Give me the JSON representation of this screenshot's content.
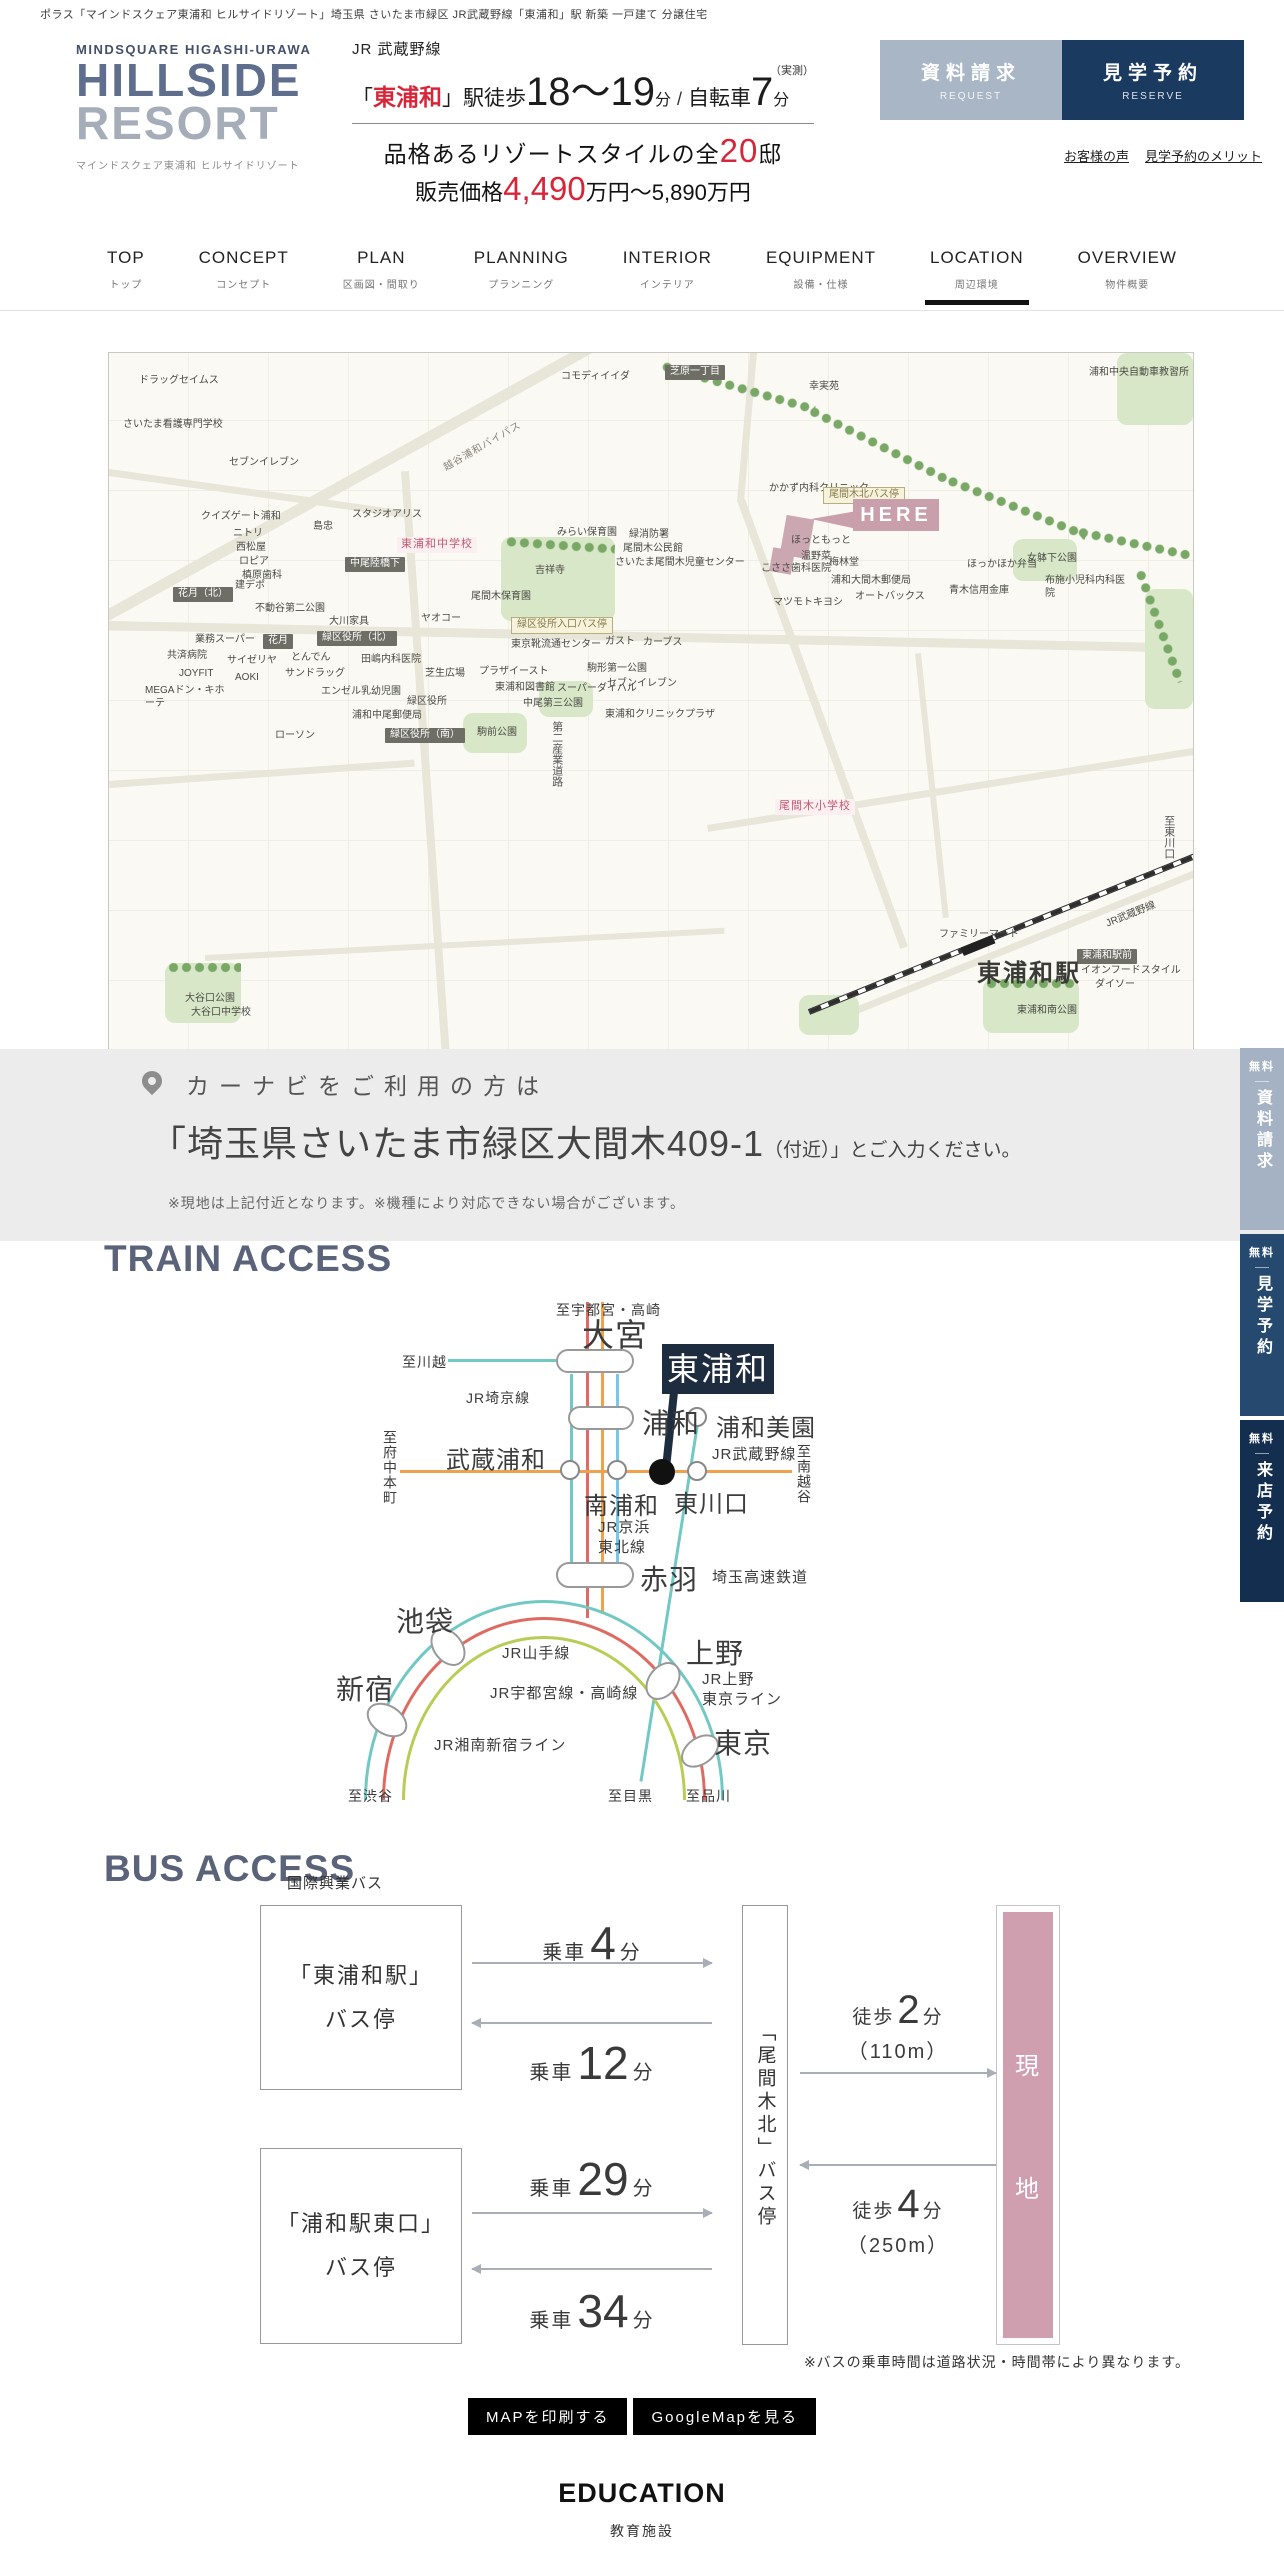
{
  "colors": {
    "accent": "#d7263a",
    "navy": "#1b3a60",
    "navy_dark": "#1e2c3f",
    "btnlight": "#a9b6c6",
    "heading": "#5a6379",
    "here": "#c99fab",
    "genchi": "#cf9fb0",
    "logo1": "#5f6e8c",
    "logo2": "#a4adb8",
    "line_teal": "#72c8c3",
    "line_red": "#df6a62",
    "line_orange": "#f0a14e",
    "line_sky": "#79c7e6",
    "line_green": "#b9cc55",
    "fb1": "#a4b2c3",
    "fb2": "#26496f",
    "fb3": "#142e50"
  },
  "topbar": {
    "text": "ポラス「マインドスクェア東浦和 ヒルサイドリゾート」埼玉県 さいたま市緑区 JR武蔵野線「東浦和」駅 新築 一戸建て 分譲住宅"
  },
  "header": {
    "brand_top": "MINDSQUARE HIGASHI-URAWA",
    "brand_main1": "HILLSIDE",
    "brand_main2": "RESORT",
    "brand_sub": "マインドスクェア東浦和 ヒルサイドリゾート",
    "line_name": "JR 武蔵野線",
    "open": "「",
    "station": "東浦和",
    "close": "」",
    "walk": "駅徒歩",
    "walk_min": "18〜19",
    "min_unit": "分",
    "slash": "/",
    "bike": "自転車",
    "bike_min": "7",
    "bike_unit": "分",
    "note": "（実測）",
    "copy_pre": "品格あるリゾートスタイルの全",
    "copy_num": "20",
    "copy_post": "邸",
    "price_pre": "販売価格",
    "price_num": "4,490",
    "price_post": "万円〜5,890万円",
    "btn_request": {
      "jp": "資料請求",
      "en": "REQUEST"
    },
    "btn_reserve": {
      "jp": "見学予約",
      "en": "RESERVE"
    },
    "link_voice": "お客様の声",
    "link_merit": "見学予約のメリット"
  },
  "nav": {
    "items": [
      {
        "en": "TOP",
        "jp": "トップ"
      },
      {
        "en": "CONCEPT",
        "jp": "コンセプト"
      },
      {
        "en": "PLAN",
        "jp": "区画図・間取り"
      },
      {
        "en": "PLANNING",
        "jp": "プランニング"
      },
      {
        "en": "INTERIOR",
        "jp": "インテリア"
      },
      {
        "en": "EQUIPMENT",
        "jp": "設備・仕様"
      },
      {
        "en": "LOCATION",
        "jp": "周辺環境",
        "active": true
      },
      {
        "en": "OVERVIEW",
        "jp": "物件概要"
      }
    ]
  },
  "map": {
    "here_label": "HERE",
    "labels": [
      {
        "t": "ドラッグセイムス",
        "x": 30,
        "y": 22
      },
      {
        "t": "さいたま看護専門学校",
        "x": 14,
        "y": 66
      },
      {
        "t": "セブンイレブン",
        "x": 120,
        "y": 104
      },
      {
        "t": "コモディイイダ",
        "x": 452,
        "y": 18
      },
      {
        "t": "幸実苑",
        "x": 700,
        "y": 28
      },
      {
        "t": "浦和中央自動車教習所",
        "x": 980,
        "y": 14,
        "w": 104
      },
      {
        "t": "越谷浦和バイパス",
        "x": 330,
        "y": 88,
        "k": "road",
        "rot": -30
      },
      {
        "t": "芝原一丁目",
        "x": 556,
        "y": 12,
        "k": "bd"
      },
      {
        "t": "クイズゲート浦和",
        "x": 92,
        "y": 158
      },
      {
        "t": "ニトリ",
        "x": 124,
        "y": 175
      },
      {
        "t": "西松屋",
        "x": 127,
        "y": 189
      },
      {
        "t": "ロピア",
        "x": 130,
        "y": 203
      },
      {
        "t": "槙原歯科",
        "x": 133,
        "y": 217
      },
      {
        "t": "島忠",
        "x": 204,
        "y": 168
      },
      {
        "t": "スタジオアリス",
        "x": 243,
        "y": 156
      },
      {
        "t": "東浦和中学校",
        "x": 288,
        "y": 184,
        "k": "bp"
      },
      {
        "t": "中尾陸橋下",
        "x": 236,
        "y": 204,
        "k": "bd"
      },
      {
        "t": "花月（北）",
        "x": 64,
        "y": 234,
        "k": "bd"
      },
      {
        "t": "建デポ",
        "x": 126,
        "y": 227
      },
      {
        "t": "不動谷第二公園",
        "x": 146,
        "y": 250
      },
      {
        "t": "大川家具",
        "x": 220,
        "y": 263
      },
      {
        "t": "みらい保育園",
        "x": 448,
        "y": 174
      },
      {
        "t": "緑消防署",
        "x": 520,
        "y": 176
      },
      {
        "t": "尾間木公民館",
        "x": 514,
        "y": 190
      },
      {
        "t": "さいたま尾間木児童センター",
        "x": 506,
        "y": 204
      },
      {
        "t": "吉祥寺",
        "x": 426,
        "y": 212
      },
      {
        "t": "尾間木保育園",
        "x": 362,
        "y": 238
      },
      {
        "t": "緑区役所入口バス停",
        "x": 402,
        "y": 264,
        "k": "bb"
      },
      {
        "t": "ヤオコー",
        "x": 312,
        "y": 260
      },
      {
        "t": "東京靴流通センター",
        "x": 402,
        "y": 286
      },
      {
        "t": "緑区役所（北）",
        "x": 208,
        "y": 278,
        "k": "bd"
      },
      {
        "t": "花月",
        "x": 154,
        "y": 281,
        "k": "bd"
      },
      {
        "t": "業務スーパー",
        "x": 86,
        "y": 281
      },
      {
        "t": "共済病院",
        "x": 58,
        "y": 297
      },
      {
        "t": "サイゼリヤ",
        "x": 118,
        "y": 302
      },
      {
        "t": "とんでん",
        "x": 182,
        "y": 299
      },
      {
        "t": "田嶋内科医院",
        "x": 252,
        "y": 301
      },
      {
        "t": "JOYFIT",
        "x": 70,
        "y": 315
      },
      {
        "t": "AOKI",
        "x": 126,
        "y": 319
      },
      {
        "t": "サンドラッグ",
        "x": 176,
        "y": 315
      },
      {
        "t": "MEGAドン・キホーテ",
        "x": 36,
        "y": 332,
        "w": 86
      },
      {
        "t": "エンゼル乳幼児園",
        "x": 212,
        "y": 333
      },
      {
        "t": "芝生広場",
        "x": 316,
        "y": 315
      },
      {
        "t": "プラザイースト",
        "x": 370,
        "y": 313
      },
      {
        "t": "東浦和図書館",
        "x": 386,
        "y": 329
      },
      {
        "t": "中尾第三公園",
        "x": 414,
        "y": 345
      },
      {
        "t": "緑区役所",
        "x": 298,
        "y": 343
      },
      {
        "t": "スーパーダイハル",
        "x": 448,
        "y": 330
      },
      {
        "t": "駒形第一公園",
        "x": 478,
        "y": 310
      },
      {
        "t": "ガスト",
        "x": 496,
        "y": 283
      },
      {
        "t": "カーブス",
        "x": 534,
        "y": 284
      },
      {
        "t": "セブンイレブン",
        "x": 498,
        "y": 325
      },
      {
        "t": "東浦和クリニックプラザ",
        "x": 496,
        "y": 356
      },
      {
        "t": "浦和中尾郵便局",
        "x": 243,
        "y": 357
      },
      {
        "t": "緑区役所（南）",
        "x": 276,
        "y": 375,
        "k": "bd"
      },
      {
        "t": "駒前公園",
        "x": 368,
        "y": 374
      },
      {
        "t": "ローソン",
        "x": 166,
        "y": 377
      },
      {
        "t": "かかず内科クリニック",
        "x": 660,
        "y": 130
      },
      {
        "t": "尾間木北バス停",
        "x": 714,
        "y": 134,
        "k": "bb"
      },
      {
        "t": "ほっともっと",
        "x": 682,
        "y": 182
      },
      {
        "t": "温野菜",
        "x": 692,
        "y": 198
      },
      {
        "t": "梅林堂",
        "x": 720,
        "y": 204
      },
      {
        "t": "こささ歯科医院",
        "x": 652,
        "y": 210
      },
      {
        "t": "浦和大間木郵便局",
        "x": 722,
        "y": 222
      },
      {
        "t": "オートバックス",
        "x": 746,
        "y": 238
      },
      {
        "t": "青木信用金庫",
        "x": 840,
        "y": 232
      },
      {
        "t": "ほっかほか弁当",
        "x": 858,
        "y": 206
      },
      {
        "t": "女躰下公園",
        "x": 918,
        "y": 200
      },
      {
        "t": "布施小児科内科医院",
        "x": 936,
        "y": 222,
        "w": 84
      },
      {
        "t": "マツモトキヨシ",
        "x": 664,
        "y": 244
      },
      {
        "t": "尾間木小学校",
        "x": 666,
        "y": 446,
        "k": "bp"
      },
      {
        "t": "ファミリーマート",
        "x": 830,
        "y": 576
      },
      {
        "t": "東浦和駅前",
        "x": 968,
        "y": 596,
        "k": "bd"
      },
      {
        "t": "イオンフードスタイル",
        "x": 972,
        "y": 612
      },
      {
        "t": "ダイソー",
        "x": 986,
        "y": 626
      },
      {
        "t": "東浦和南公園",
        "x": 908,
        "y": 652
      },
      {
        "t": "大谷口公園",
        "x": 76,
        "y": 640
      },
      {
        "t": "大谷口中学校",
        "x": 82,
        "y": 654
      },
      {
        "t": "至東川口",
        "x": 1052,
        "y": 462,
        "k": "v"
      },
      {
        "t": "第二産業道路",
        "x": 440,
        "y": 368,
        "k": "v"
      },
      {
        "t": "JR武蔵野線",
        "x": 996,
        "y": 556,
        "rot": -22
      },
      {
        "t": "東浦和駅",
        "x": 868,
        "y": 606,
        "k": "big"
      }
    ]
  },
  "carnavi": {
    "title": "カーナビをご利用の方は",
    "addr_big": "「埼玉県さいたま市緑区大間木409-1",
    "addr_small": "（付近）」とご入力ください。",
    "note": "※現地は上記付近となります。※機種により対応できない場合がございます。"
  },
  "train": {
    "heading": "TRAIN ACCESS",
    "callout": "東浦和",
    "labels": [
      {
        "t": "至宇都宮・高崎",
        "x": 556,
        "y": 1300,
        "s": 14
      },
      {
        "t": "大宮",
        "x": 582,
        "y": 1310,
        "s": 32
      },
      {
        "t": "至川越",
        "x": 402,
        "y": 1352,
        "s": 14
      },
      {
        "t": "JR埼京線",
        "x": 466,
        "y": 1388,
        "s": 14
      },
      {
        "t": "浦和",
        "x": 642,
        "y": 1402,
        "s": 28
      },
      {
        "t": "浦和美園",
        "x": 716,
        "y": 1408,
        "s": 24
      },
      {
        "t": "武蔵浦和",
        "x": 446,
        "y": 1440,
        "s": 24
      },
      {
        "t": "至府中本町",
        "x": 380,
        "y": 1430,
        "s": 14,
        "v": 1
      },
      {
        "t": "JR武蔵野線",
        "x": 712,
        "y": 1443,
        "s": 15
      },
      {
        "t": "至南越谷",
        "x": 794,
        "y": 1444,
        "s": 14,
        "v": 1
      },
      {
        "t": "南浦和",
        "x": 584,
        "y": 1486,
        "s": 24
      },
      {
        "t": "東川口",
        "x": 674,
        "y": 1484,
        "s": 24
      },
      {
        "t": "JR京浜",
        "x": 598,
        "y": 1516,
        "s": 15
      },
      {
        "t": "東北線",
        "x": 598,
        "y": 1536,
        "s": 15
      },
      {
        "t": "赤羽",
        "x": 640,
        "y": 1558,
        "s": 28
      },
      {
        "t": "埼玉高速鉄道",
        "x": 712,
        "y": 1566,
        "s": 15
      },
      {
        "t": "池袋",
        "x": 396,
        "y": 1600,
        "s": 28
      },
      {
        "t": "JR山手線",
        "x": 502,
        "y": 1642,
        "s": 15
      },
      {
        "t": "上野",
        "x": 686,
        "y": 1632,
        "s": 28
      },
      {
        "t": "JR上野",
        "x": 702,
        "y": 1668,
        "s": 15
      },
      {
        "t": "東京ライン",
        "x": 702,
        "y": 1688,
        "s": 15
      },
      {
        "t": "JR宇都宮線・高崎線",
        "x": 490,
        "y": 1682,
        "s": 15
      },
      {
        "t": "新宿",
        "x": 336,
        "y": 1668,
        "s": 28
      },
      {
        "t": "東京",
        "x": 714,
        "y": 1722,
        "s": 28
      },
      {
        "t": "JR湘南新宿ライン",
        "x": 434,
        "y": 1734,
        "s": 15
      },
      {
        "t": "至渋谷",
        "x": 348,
        "y": 1786,
        "s": 14
      },
      {
        "t": "至目黒",
        "x": 608,
        "y": 1786,
        "s": 14
      },
      {
        "t": "至品川",
        "x": 686,
        "y": 1786,
        "s": 14
      }
    ]
  },
  "bus": {
    "heading": "BUS ACCESS",
    "operator": "国際興業バス",
    "stop1": {
      "line1": "「東浦和駅」",
      "line2": "バス停"
    },
    "stop2": {
      "line1": "「浦和駅東口」",
      "line2": "バス停"
    },
    "mid_stop": "「尾間木北」バス停",
    "rides": [
      {
        "pre": "乗車",
        "num": "4",
        "unit": "分",
        "y": 1916
      },
      {
        "pre": "乗車",
        "num": "12",
        "unit": "分",
        "y": 2036
      },
      {
        "pre": "乗車",
        "num": "29",
        "unit": "分",
        "y": 2152
      },
      {
        "pre": "乗車",
        "num": "34",
        "unit": "分",
        "y": 2284
      }
    ],
    "walks": [
      {
        "pre": "徒歩",
        "num": "2",
        "unit": "分",
        "dist": "（110m）",
        "y": 1988
      },
      {
        "pre": "徒歩",
        "num": "4",
        "unit": "分",
        "dist": "（250m）",
        "y": 2182
      }
    ],
    "genchi_chars": [
      {
        "t": "現"
      },
      {
        "t": "地"
      }
    ],
    "note": "※バスの乗車時間は道路状況・時間帯により異なります。"
  },
  "actions": {
    "print": "MAPを印刷する",
    "gmap": "GoogleMapを見る"
  },
  "next_section": {
    "en": "EDUCATION",
    "jp": "教育施設"
  },
  "floatbtns": [
    {
      "free": "無料",
      "label": "資料請求",
      "cls": "c1",
      "y": 1048
    },
    {
      "free": "無料",
      "label": "見学予約",
      "cls": "c2",
      "y": 1234
    },
    {
      "free": "無料",
      "label": "来店予約",
      "cls": "c3",
      "y": 1420
    }
  ]
}
